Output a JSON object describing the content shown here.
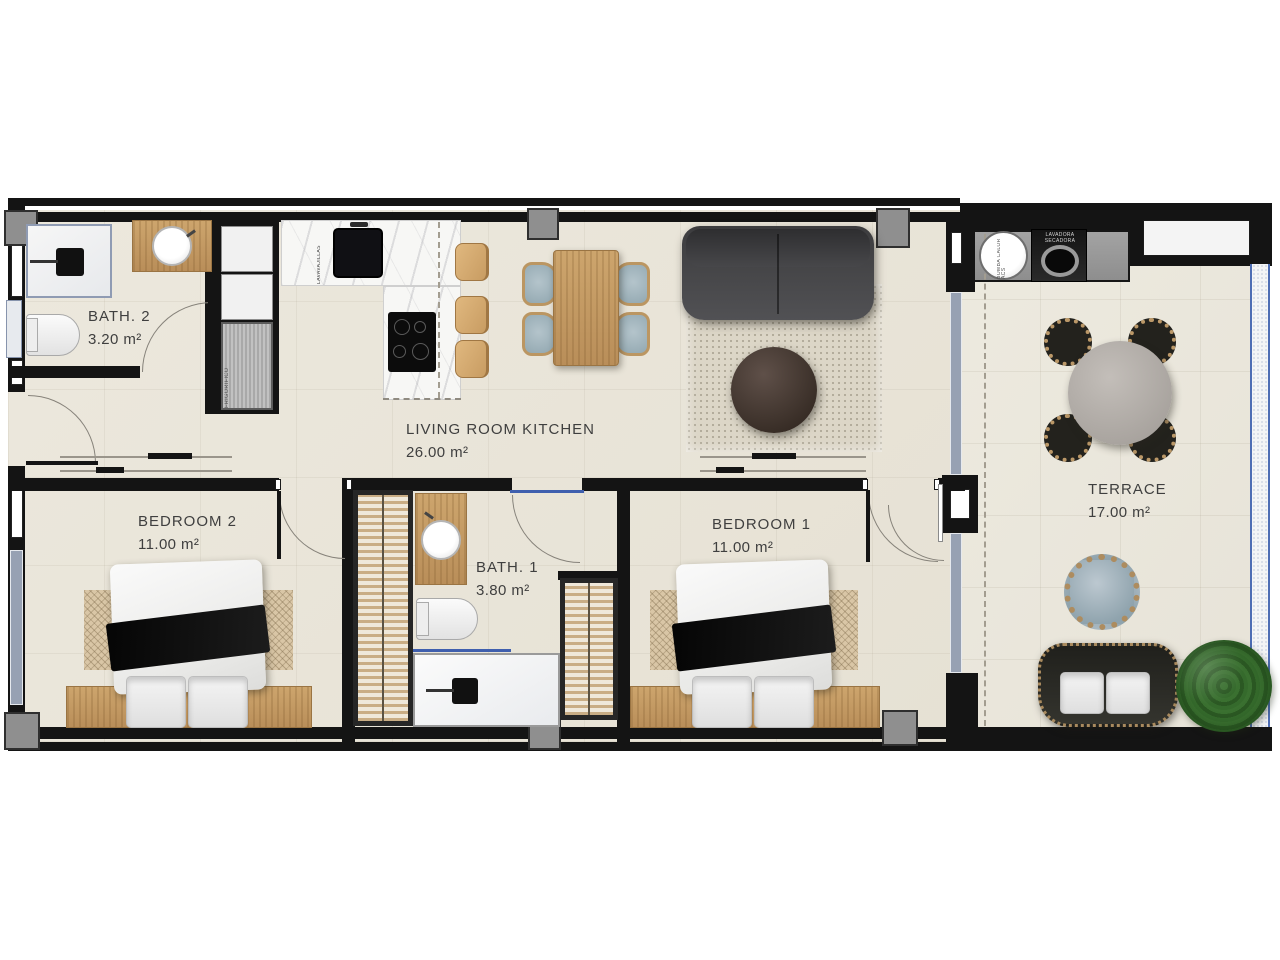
{
  "plan_title": "Apartment floor plan",
  "rooms": {
    "bath2": {
      "name": "BATH. 2",
      "area": "3.20 m²"
    },
    "living": {
      "name": "LIVING ROOM KITCHEN",
      "area": "26.00 m²"
    },
    "bedroom2": {
      "name": "BEDROOM 2",
      "area": "11.00 m²"
    },
    "bath1": {
      "name": "BATH. 1",
      "area": "3.80 m²"
    },
    "bedroom1": {
      "name": "BEDROOM 1",
      "area": "11.00 m²"
    },
    "terrace": {
      "name": "TERRACE",
      "area": "17.00 m²"
    }
  },
  "appliances": {
    "dishwasher": {
      "label": "LAVAVAJILLAS"
    },
    "fridge": {
      "label": "FRIGORIFICO"
    },
    "heat_pump": {
      "label": "BOMBA CALOR ACS"
    },
    "washer_dryer": {
      "label": "LAVADORA SECADORA"
    }
  },
  "colors": {
    "wall": "#141414",
    "floor": "#e9e4d8",
    "wood": "#c49a62",
    "sofa": "#474749",
    "glazing": "#97a1b3",
    "label_text": "#3f3f3f"
  }
}
